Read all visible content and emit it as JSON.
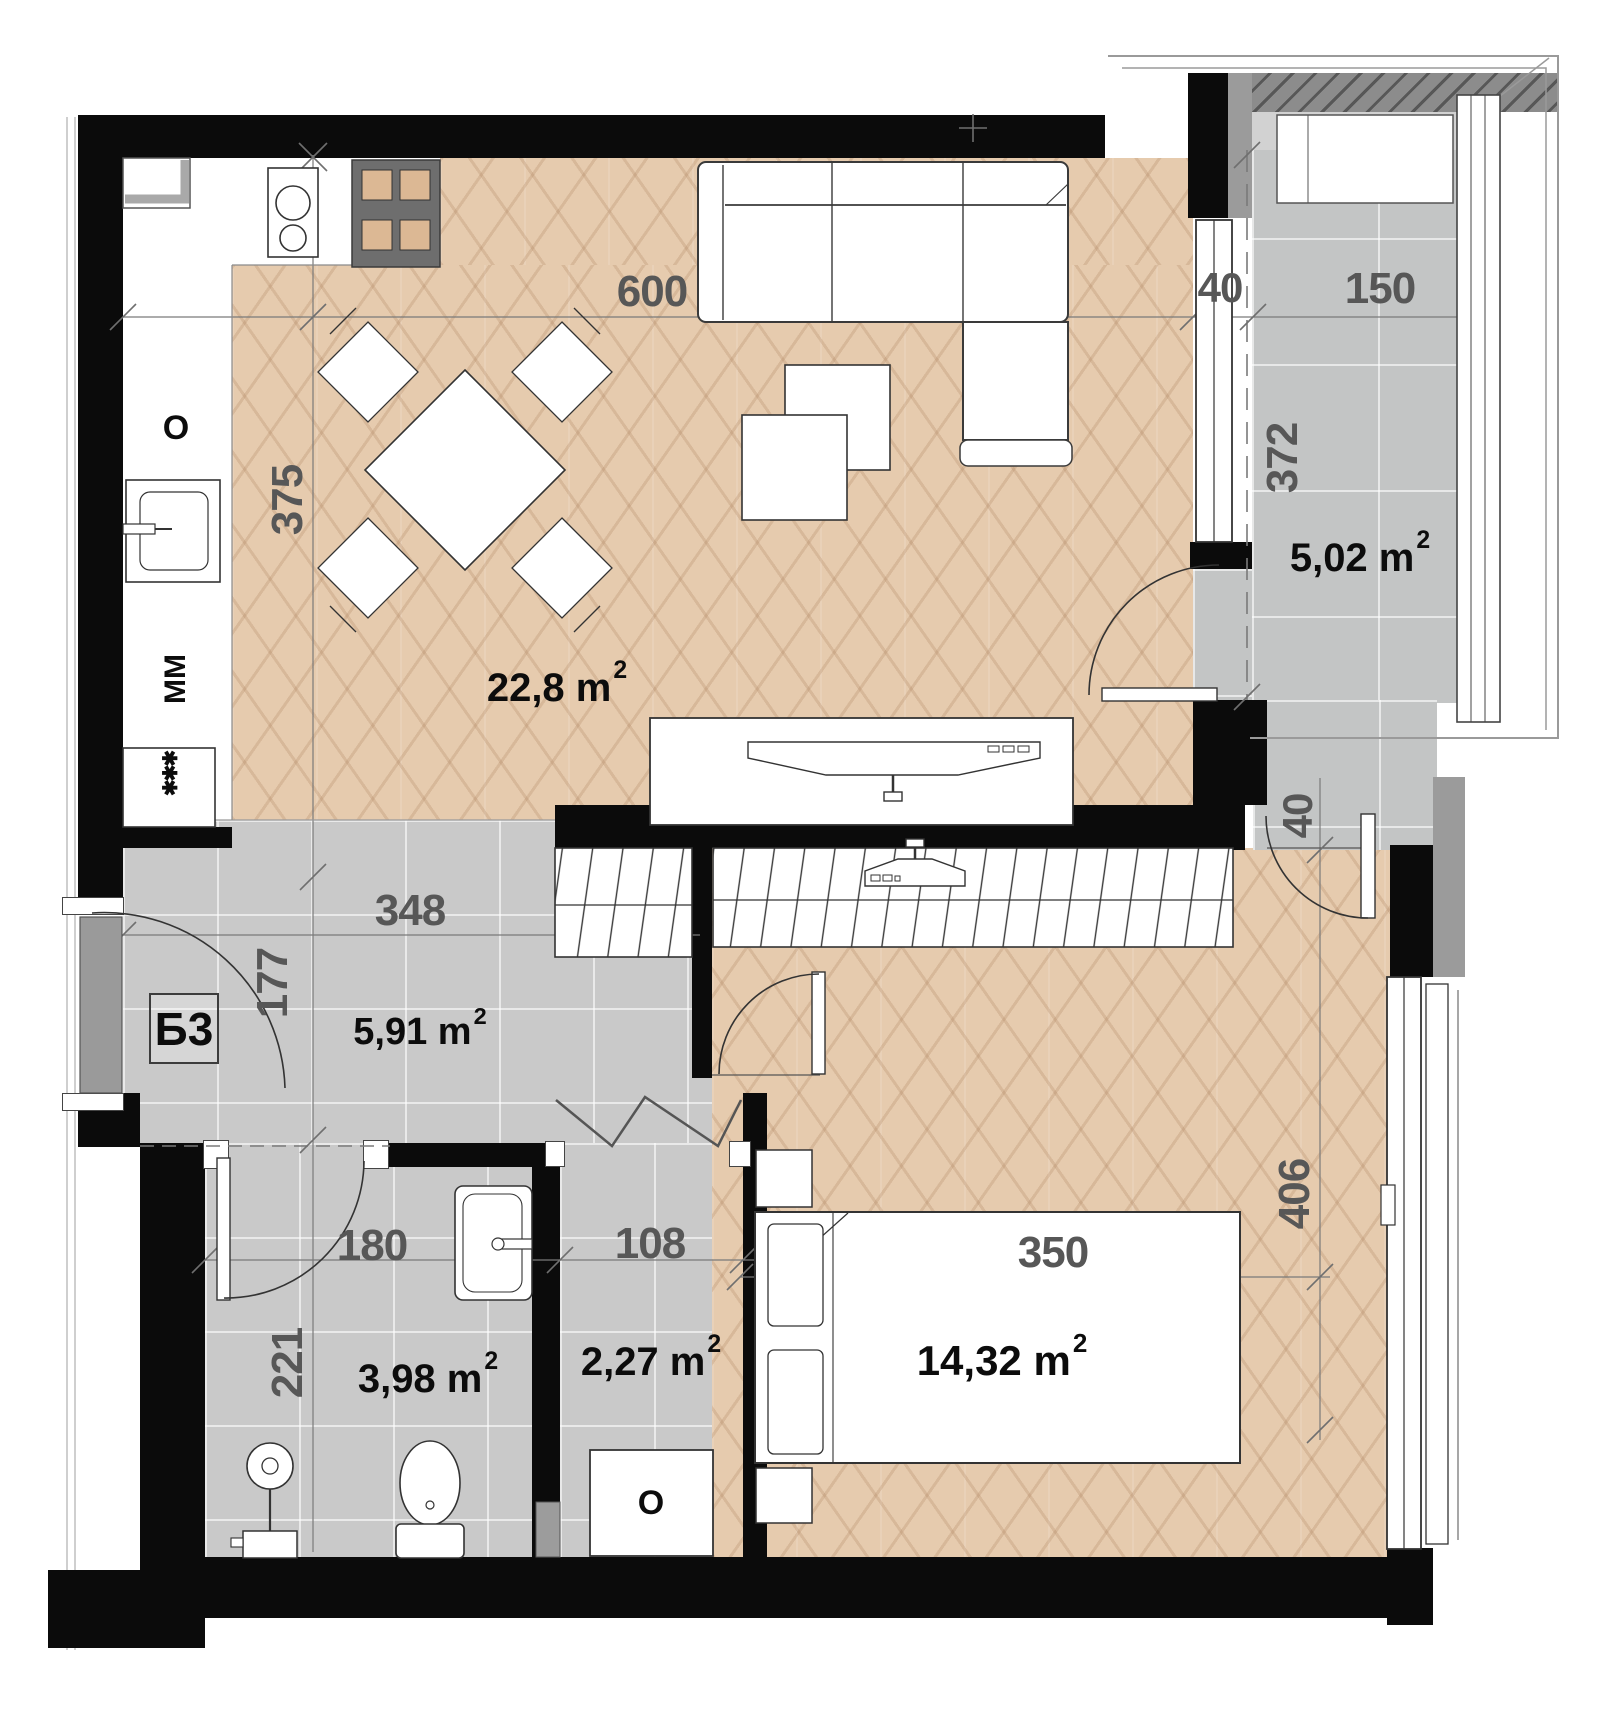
{
  "apartment": {
    "unit_label": "Б3"
  },
  "rooms": {
    "living_kitchen": {
      "area_text": "22,8 m",
      "area_sup": "2"
    },
    "terrace": {
      "area_text": "5,02 m",
      "area_sup": "2"
    },
    "hall": {
      "area_text": "5,91 m",
      "area_sup": "2"
    },
    "bathroom": {
      "area_text": "3,98 m",
      "area_sup": "2"
    },
    "storage": {
      "area_text": "2,27 m",
      "area_sup": "2"
    },
    "bedroom": {
      "area_text": "14,32 m",
      "area_sup": "2"
    }
  },
  "dimensions_cm": {
    "living_width": "600",
    "living_depth": "375",
    "terrace_wall": "40",
    "terrace_width": "150",
    "terrace_depth": "372",
    "hall_width": "348",
    "hall_depth": "177",
    "bathroom_width": "180",
    "bathroom_depth": "221",
    "storage_width": "108",
    "bedroom_width": "350",
    "bedroom_depth": "406",
    "terrace_ledge": "40"
  },
  "appliances": {
    "oven_label": "O",
    "dishwasher_label": "MM",
    "freezer_label": "✱✱✱",
    "water_heater_label": "O"
  },
  "colors": {
    "wall": "#0b0b0b",
    "wood_floor": "#e6cbae",
    "tile_floor": "#c9c9c9",
    "terrace_tile": "#c3c5c5",
    "hatch_wall": "#8c8c8c",
    "dim_text": "#575757",
    "area_text": "#0c0c0c"
  }
}
